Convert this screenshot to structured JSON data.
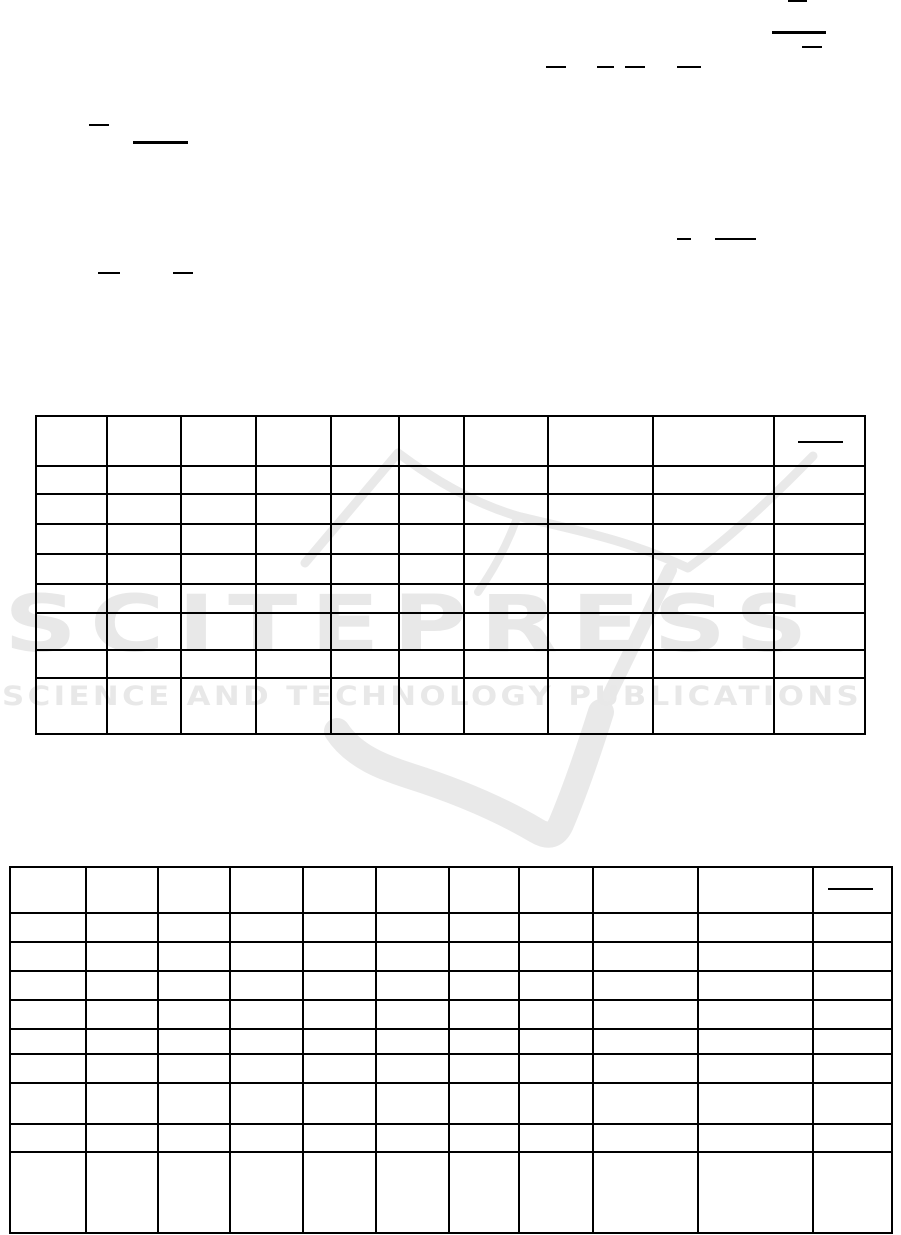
{
  "watermark": {
    "brand": "SCITEPRESS",
    "tagline": "SCIENCE AND TECHNOLOGY PUBLICATIONS",
    "text_color": "#e8e8e8",
    "logo_color": "#e9e9e9"
  },
  "page": {
    "background": "#ffffff",
    "line_color": "#000000"
  },
  "rules": [
    {
      "name": "fraction-bar-top-1",
      "x": 788,
      "y": 0,
      "w": 19,
      "h": 2
    },
    {
      "name": "fraction-bar-top-2-thick",
      "x": 772,
      "y": 31,
      "w": 54,
      "h": 3
    },
    {
      "name": "fraction-bar-top-3",
      "x": 802,
      "y": 46,
      "w": 20,
      "h": 1.5
    },
    {
      "name": "fraction-bar-row2-1",
      "x": 546,
      "y": 66,
      "w": 20,
      "h": 1.5
    },
    {
      "name": "fraction-bar-row2-2",
      "x": 597,
      "y": 66,
      "w": 17,
      "h": 1.5
    },
    {
      "name": "fraction-bar-row2-3",
      "x": 625,
      "y": 66,
      "w": 20,
      "h": 1.5
    },
    {
      "name": "fraction-bar-row2-4",
      "x": 677,
      "y": 66,
      "w": 24,
      "h": 1.5
    },
    {
      "name": "fraction-bar-left-1",
      "x": 89,
      "y": 124,
      "w": 20,
      "h": 1.5
    },
    {
      "name": "fraction-bar-left-2-thick",
      "x": 133,
      "y": 141,
      "w": 55,
      "h": 3
    },
    {
      "name": "fraction-bar-mid-1",
      "x": 677,
      "y": 238,
      "w": 14,
      "h": 1.5
    },
    {
      "name": "fraction-bar-mid-2",
      "x": 715,
      "y": 238,
      "w": 41,
      "h": 1.5
    },
    {
      "name": "fraction-bar-left-3",
      "x": 98,
      "y": 272,
      "w": 22,
      "h": 1.5
    },
    {
      "name": "fraction-bar-left-4",
      "x": 173,
      "y": 272,
      "w": 20,
      "h": 1.5
    },
    {
      "name": "table1-header-fraction-bar",
      "x": 798,
      "y": 441,
      "w": 45,
      "h": 1.5
    },
    {
      "name": "table2-header-fraction-bar",
      "x": 828,
      "y": 888,
      "w": 45,
      "h": 1.5
    }
  ],
  "tables": [
    {
      "name": "results-table-1",
      "x": 35,
      "y": 415,
      "col_widths": [
        71,
        74,
        75,
        75,
        68,
        65,
        84,
        105,
        121,
        91
      ],
      "row_heights": [
        50,
        28,
        30,
        30,
        30,
        29,
        37,
        28,
        56
      ]
    },
    {
      "name": "results-table-2",
      "x": 9,
      "y": 866,
      "col_widths": [
        76,
        72,
        72,
        73,
        73,
        73,
        70,
        74,
        105,
        115,
        79
      ],
      "row_heights": [
        46,
        29,
        29,
        29,
        29,
        25,
        29,
        41,
        28,
        81
      ]
    }
  ]
}
